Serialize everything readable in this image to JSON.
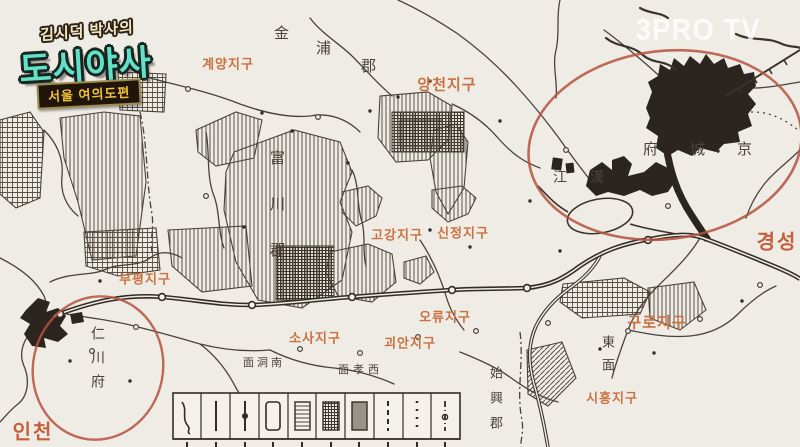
{
  "show_logo": {
    "tagline": "김시덕 박사의",
    "title": "도시야사",
    "episode": "서울 여의도편"
  },
  "watermark": {
    "text": "3PRO TV"
  },
  "map": {
    "district_labels": [
      {
        "text": "계양지구"
      },
      {
        "text": "양천지구"
      },
      {
        "text": "고강지구"
      },
      {
        "text": "신정지구"
      },
      {
        "text": "부평지구"
      },
      {
        "text": "소사지구"
      },
      {
        "text": "오류지구"
      },
      {
        "text": "괴안지구"
      },
      {
        "text": "구로지구"
      },
      {
        "text": "시흥지구"
      }
    ],
    "city_labels": [
      {
        "text": "인천"
      },
      {
        "text": "경성"
      }
    ],
    "hanja_labels": {
      "gimpo_gun": [
        "金",
        "浦",
        "郡"
      ],
      "bucheon_gun": "富川郡",
      "gyeongseong_bu": "府城京",
      "han_river": "江漢",
      "incheon_bu": "仁川府",
      "siheung_gun": "始興郡",
      "dong_myeon": "東面",
      "namdong_myeon": "面洞南",
      "seo_myeon": "面孝西"
    },
    "highlight_circles": [
      {
        "name": "gyeongseong-area"
      },
      {
        "name": "incheon-area"
      }
    ]
  },
  "colors": {
    "map_background": "#efece6",
    "map_ink": "#4a423a",
    "urban_fill": "#2b241f",
    "district_label": "#c9713f",
    "city_label": "#c4603c",
    "highlight_circle": "#b5523d",
    "logo_title": "#62e0c8",
    "logo_tagline": "#f1e9c6",
    "episode_text": "#efc23a",
    "episode_background": "#20150b",
    "watermark": "#ffffff"
  }
}
